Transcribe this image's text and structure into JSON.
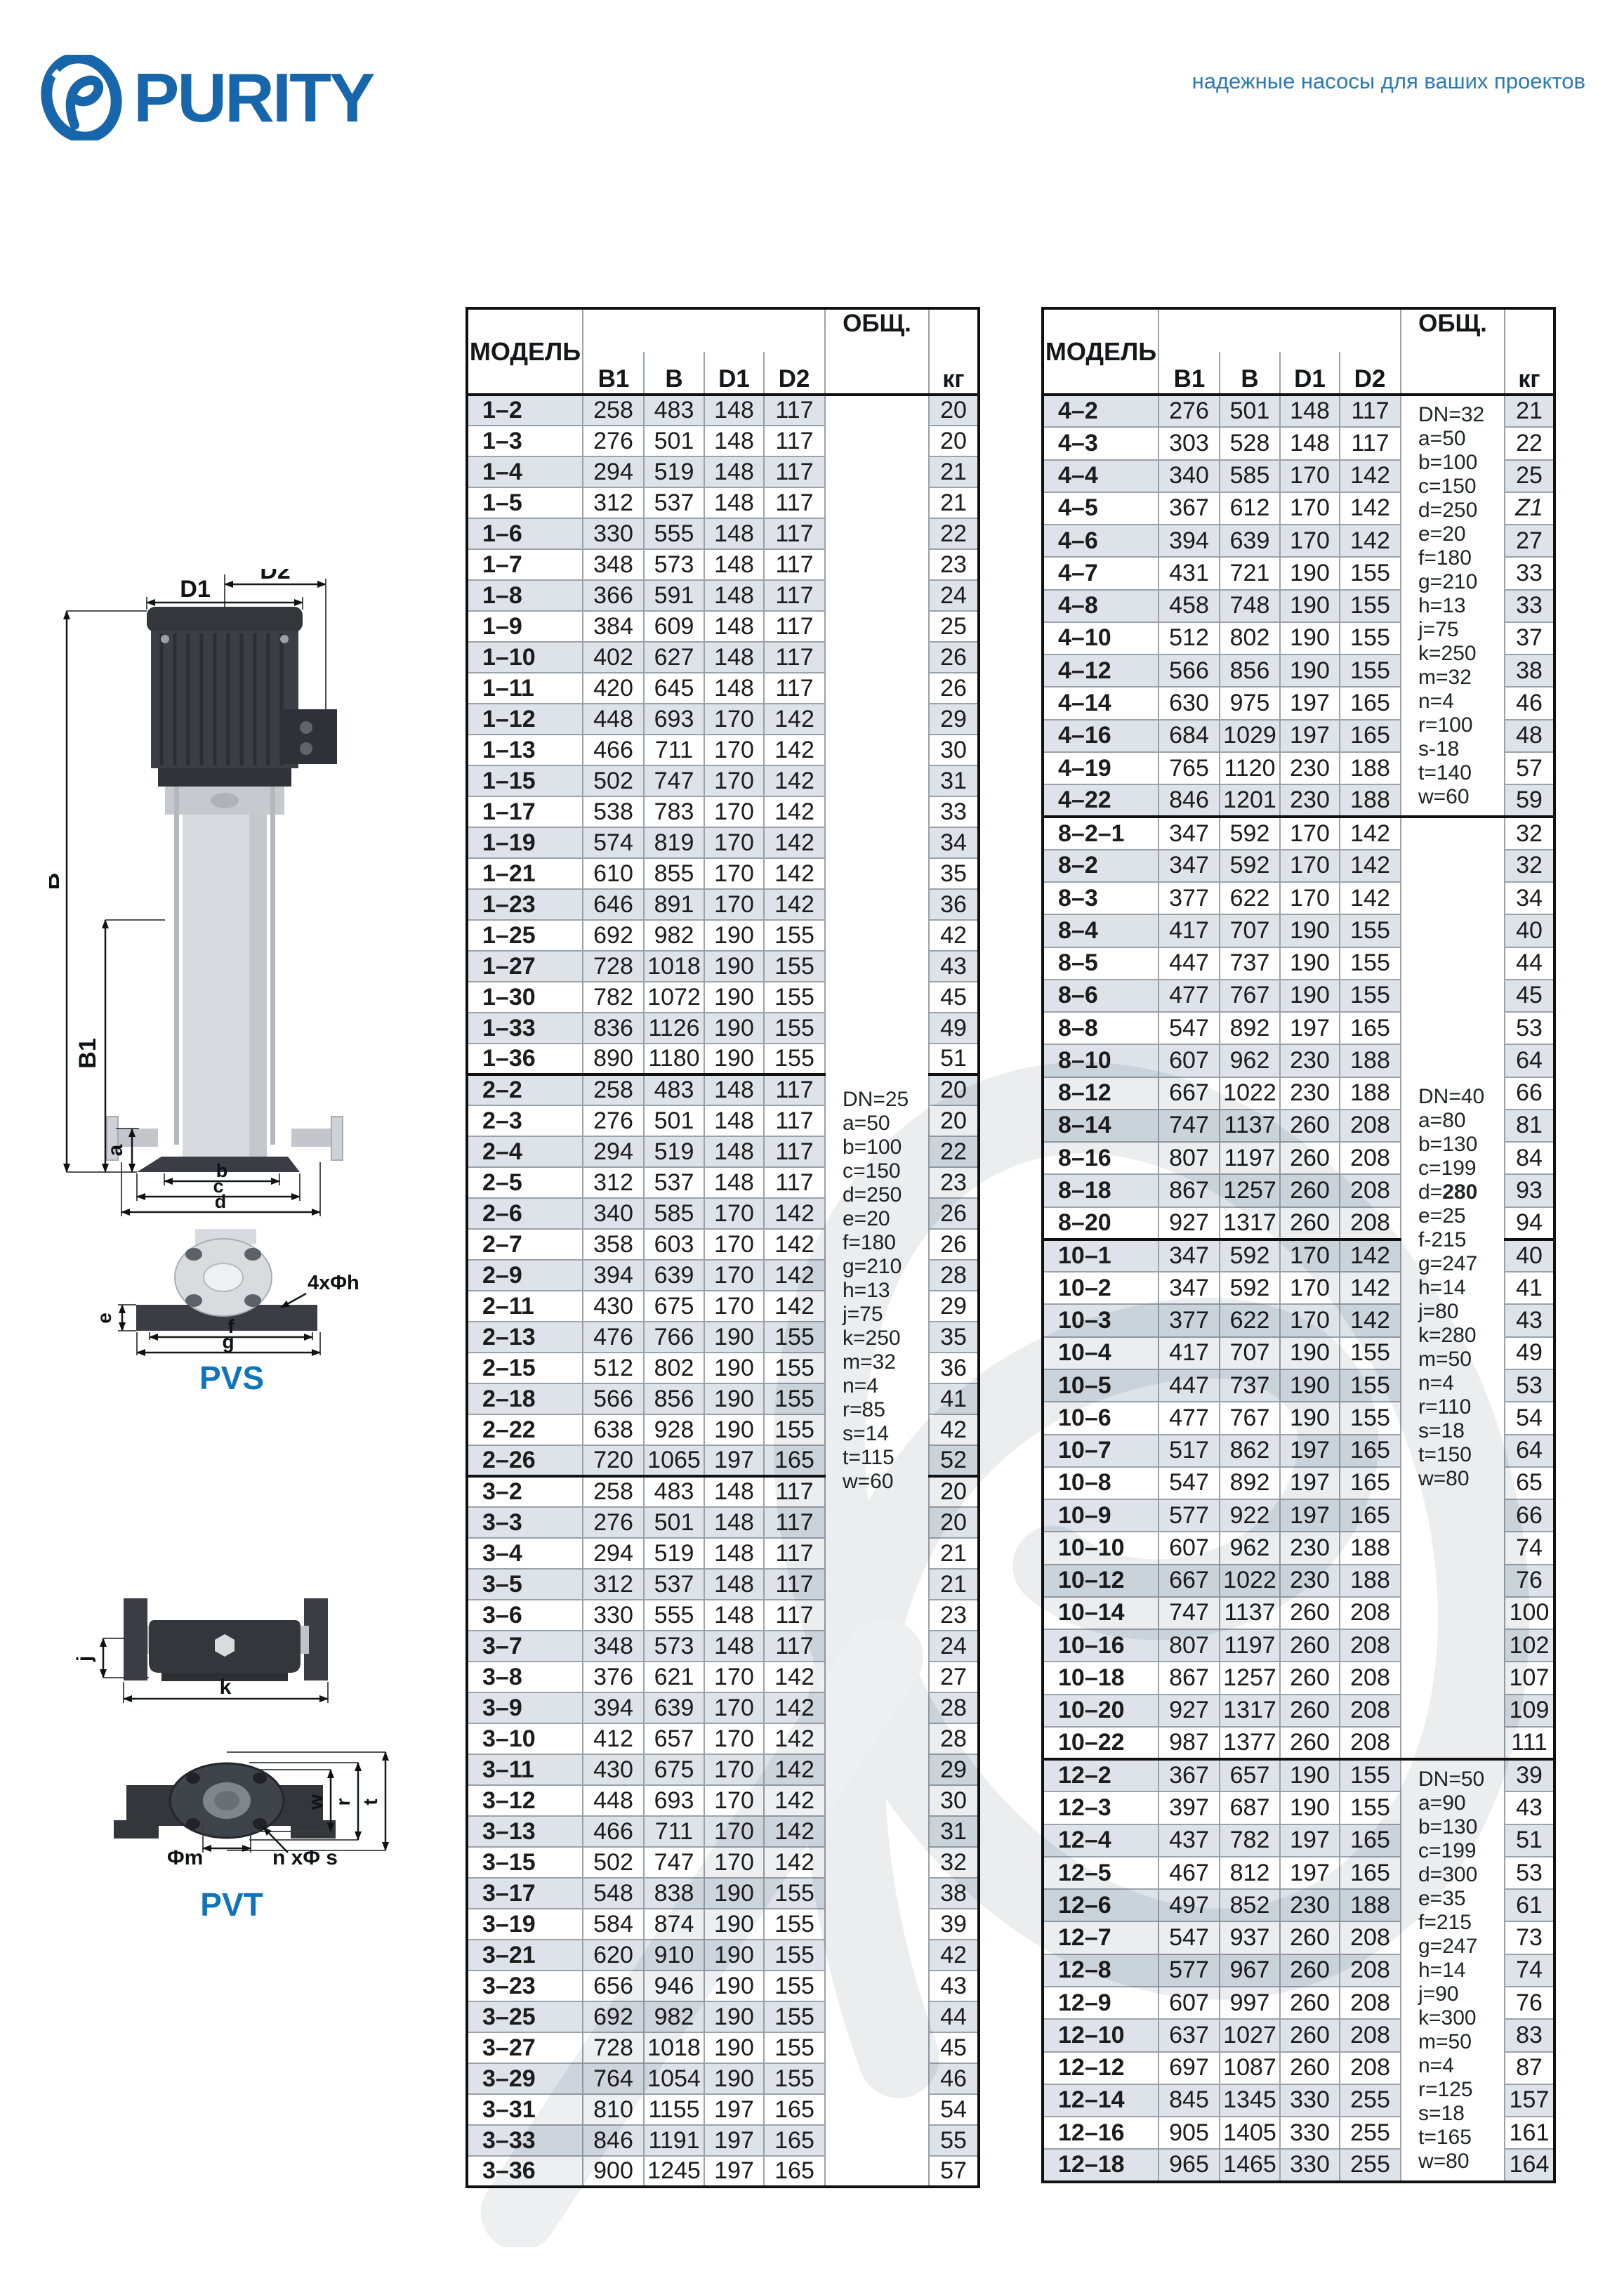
{
  "brand": {
    "name": "PURITY",
    "tagline": "надежные насосы для ваших проектов"
  },
  "columns": {
    "model": "МОДЕЛЬ",
    "b1": "B1",
    "b": "B",
    "d1": "D1",
    "d2": "D2",
    "obshch": "ОБЩ.",
    "kg": "кг"
  },
  "diagrams": {
    "pvs_label": "PVS",
    "pvt_label": "PVT",
    "dims": {
      "D1": "D1",
      "D2": "D2",
      "B": "B",
      "B1": "B1",
      "a": "a",
      "b": "b",
      "c": "c",
      "d": "d",
      "e": "e",
      "f": "f",
      "g": "g",
      "h4": "4xΦh",
      "j": "j",
      "k": "k",
      "w": "w",
      "r": "r",
      "t": "t",
      "m": "Φm",
      "ns": "n xΦ s"
    }
  },
  "tables": [
    {
      "name": "pvs-pvt-1-2-3",
      "note_groups": [
        {
          "sections": [
            0,
            1,
            2
          ],
          "lines": [
            "DN=25",
            "a=50",
            "b=100",
            "c=150",
            "d=250",
            "e=20",
            "f=180",
            "g=210",
            "h=13",
            "j=75",
            "k=250",
            "m=32",
            "n=4",
            "r=85",
            "s=14",
            "t=115",
            "w=60"
          ]
        }
      ],
      "sections": [
        {
          "rows": [
            [
              "1–2",
              258,
              483,
              148,
              117,
              "20"
            ],
            [
              "1–3",
              276,
              501,
              148,
              117,
              "20"
            ],
            [
              "1–4",
              294,
              519,
              148,
              117,
              "21"
            ],
            [
              "1–5",
              312,
              537,
              148,
              117,
              "21"
            ],
            [
              "1–6",
              330,
              555,
              148,
              117,
              "22"
            ],
            [
              "1–7",
              348,
              573,
              148,
              117,
              "23"
            ],
            [
              "1–8",
              366,
              591,
              148,
              117,
              "24"
            ],
            [
              "1–9",
              384,
              609,
              148,
              117,
              "25"
            ],
            [
              "1–10",
              402,
              627,
              148,
              117,
              "26"
            ],
            [
              "1–11",
              420,
              645,
              148,
              117,
              "26"
            ],
            [
              "1–12",
              448,
              693,
              170,
              142,
              "29"
            ],
            [
              "1–13",
              466,
              711,
              170,
              142,
              "30"
            ],
            [
              "1–15",
              502,
              747,
              170,
              142,
              "31"
            ],
            [
              "1–17",
              538,
              783,
              170,
              142,
              "33"
            ],
            [
              "1–19",
              574,
              819,
              170,
              142,
              "34"
            ],
            [
              "1–21",
              610,
              855,
              170,
              142,
              "35"
            ],
            [
              "1–23",
              646,
              891,
              170,
              142,
              "36"
            ],
            [
              "1–25",
              692,
              982,
              190,
              155,
              "42"
            ],
            [
              "1–27",
              728,
              1018,
              190,
              155,
              "43"
            ],
            [
              "1–30",
              782,
              1072,
              190,
              155,
              "45"
            ],
            [
              "1–33",
              836,
              1126,
              190,
              155,
              "49"
            ],
            [
              "1–36",
              890,
              1180,
              190,
              155,
              "51"
            ]
          ]
        },
        {
          "rows": [
            [
              "2–2",
              258,
              483,
              148,
              117,
              "20"
            ],
            [
              "2–3",
              276,
              501,
              148,
              117,
              "20"
            ],
            [
              "2–4",
              294,
              519,
              148,
              117,
              "22"
            ],
            [
              "2–5",
              312,
              537,
              148,
              117,
              "23"
            ],
            [
              "2–6",
              340,
              585,
              170,
              142,
              "26"
            ],
            [
              "2–7",
              358,
              603,
              170,
              142,
              "26"
            ],
            [
              "2–9",
              394,
              639,
              170,
              142,
              "28"
            ],
            [
              "2–11",
              430,
              675,
              170,
              142,
              "29"
            ],
            [
              "2–13",
              476,
              766,
              190,
              155,
              "35"
            ],
            [
              "2–15",
              512,
              802,
              190,
              155,
              "36"
            ],
            [
              "2–18",
              566,
              856,
              190,
              155,
              "41"
            ],
            [
              "2–22",
              638,
              928,
              190,
              155,
              "42"
            ],
            [
              "2–26",
              720,
              1065,
              197,
              165,
              "52"
            ]
          ]
        },
        {
          "rows": [
            [
              "3–2",
              258,
              483,
              148,
              117,
              "20"
            ],
            [
              "3–3",
              276,
              501,
              148,
              117,
              "20"
            ],
            [
              "3–4",
              294,
              519,
              148,
              117,
              "21"
            ],
            [
              "3–5",
              312,
              537,
              148,
              117,
              "21"
            ],
            [
              "3–6",
              330,
              555,
              148,
              117,
              "23"
            ],
            [
              "3–7",
              348,
              573,
              148,
              117,
              "24"
            ],
            [
              "3–8",
              376,
              621,
              170,
              142,
              "27"
            ],
            [
              "3–9",
              394,
              639,
              170,
              142,
              "28"
            ],
            [
              "3–10",
              412,
              657,
              170,
              142,
              "28"
            ],
            [
              "3–11",
              430,
              675,
              170,
              142,
              "29"
            ],
            [
              "3–12",
              448,
              693,
              170,
              142,
              "30"
            ],
            [
              "3–13",
              466,
              711,
              170,
              142,
              "31"
            ],
            [
              "3–15",
              502,
              747,
              170,
              142,
              "32"
            ],
            [
              "3–17",
              548,
              838,
              190,
              155,
              "38"
            ],
            [
              "3–19",
              584,
              874,
              190,
              155,
              "39"
            ],
            [
              "3–21",
              620,
              910,
              190,
              155,
              "42"
            ],
            [
              "3–23",
              656,
              946,
              190,
              155,
              "43"
            ],
            [
              "3–25",
              692,
              982,
              190,
              155,
              "44"
            ],
            [
              "3–27",
              728,
              1018,
              190,
              155,
              "45"
            ],
            [
              "3–29",
              764,
              1054,
              190,
              155,
              "46"
            ],
            [
              "3–31",
              810,
              1155,
              197,
              165,
              "54"
            ],
            [
              "3–33",
              846,
              1191,
              197,
              165,
              "55"
            ],
            [
              "3–36",
              900,
              1245,
              197,
              165,
              "57"
            ]
          ]
        }
      ]
    },
    {
      "name": "pvs-pvt-4-8-10-12",
      "note_groups": [
        {
          "sections": [
            0
          ],
          "lines": [
            "DN=32",
            "a=50",
            "b=100",
            "c=150",
            "d=250",
            "e=20",
            "f=180",
            "g=210",
            "h=13",
            "j=75",
            "k=250",
            "m=32",
            "n=4",
            "r=100",
            "s-18",
            "t=140",
            "w=60"
          ]
        },
        {
          "sections": [
            1,
            2
          ],
          "lines": [
            "DN=40",
            "a=80",
            "b=130",
            "c=199",
            "d=**280**",
            "e=25",
            "f-215",
            "g=247",
            "h=14",
            "j=80",
            "k=280",
            "m=50",
            "n=4",
            "r=110",
            "s=18",
            "t=150",
            "w=80"
          ]
        },
        {
          "sections": [
            3
          ],
          "lines": [
            "DN=50",
            "a=90",
            "b=130",
            "c=199",
            "d=300",
            "e=35",
            "f=215",
            "g=247",
            "h=14",
            "j=90",
            "k=300",
            "m=50",
            "n=4",
            "r=125",
            "s=18",
            "t=165",
            "w=80"
          ]
        }
      ],
      "sections": [
        {
          "rows": [
            [
              "4–2",
              276,
              501,
              148,
              117,
              "21"
            ],
            [
              "4–3",
              303,
              528,
              148,
              117,
              "22"
            ],
            [
              "4–4",
              340,
              585,
              170,
              142,
              "25"
            ],
            [
              "4–5",
              367,
              612,
              170,
              142,
              "Z1"
            ],
            [
              "4–6",
              394,
              639,
              170,
              142,
              "27"
            ],
            [
              "4–7",
              431,
              721,
              190,
              155,
              "33"
            ],
            [
              "4–8",
              458,
              748,
              190,
              155,
              "33"
            ],
            [
              "4–10",
              512,
              802,
              190,
              155,
              "37"
            ],
            [
              "4–12",
              566,
              856,
              190,
              155,
              "38"
            ],
            [
              "4–14",
              630,
              975,
              197,
              165,
              "46"
            ],
            [
              "4–16",
              684,
              1029,
              197,
              165,
              "48"
            ],
            [
              "4–19",
              765,
              1120,
              230,
              188,
              "57"
            ],
            [
              "4–22",
              846,
              1201,
              230,
              188,
              "59"
            ]
          ]
        },
        {
          "rows": [
            [
              "8–2–1",
              347,
              592,
              170,
              142,
              "32"
            ],
            [
              "8–2",
              347,
              592,
              170,
              142,
              "32"
            ],
            [
              "8–3",
              377,
              622,
              170,
              142,
              "34"
            ],
            [
              "8–4",
              417,
              707,
              190,
              155,
              "40"
            ],
            [
              "8–5",
              447,
              737,
              190,
              155,
              "44"
            ],
            [
              "8–6",
              477,
              767,
              190,
              155,
              "45"
            ],
            [
              "8–8",
              547,
              892,
              197,
              165,
              "53"
            ],
            [
              "8–10",
              607,
              962,
              230,
              188,
              "64"
            ],
            [
              "8–12",
              667,
              1022,
              230,
              188,
              "66"
            ],
            [
              "8–14",
              747,
              1137,
              260,
              208,
              "81"
            ],
            [
              "8–16",
              807,
              1197,
              260,
              208,
              "84"
            ],
            [
              "8–18",
              867,
              1257,
              260,
              208,
              "93"
            ],
            [
              "8–20",
              927,
              1317,
              260,
              208,
              "94"
            ]
          ]
        },
        {
          "rows": [
            [
              "10–1",
              347,
              592,
              170,
              142,
              "40"
            ],
            [
              "10–2",
              347,
              592,
              170,
              142,
              "41"
            ],
            [
              "10–3",
              377,
              622,
              170,
              142,
              "43"
            ],
            [
              "10–4",
              417,
              707,
              190,
              155,
              "49"
            ],
            [
              "10–5",
              447,
              737,
              190,
              155,
              "53"
            ],
            [
              "10–6",
              477,
              767,
              190,
              155,
              "54"
            ],
            [
              "10–7",
              517,
              862,
              197,
              165,
              "64"
            ],
            [
              "10–8",
              547,
              892,
              197,
              165,
              "65"
            ],
            [
              "10–9",
              577,
              922,
              197,
              165,
              "66"
            ],
            [
              "10–10",
              607,
              962,
              230,
              188,
              "74"
            ],
            [
              "10–12",
              667,
              1022,
              230,
              188,
              "76"
            ],
            [
              "10–14",
              747,
              1137,
              260,
              208,
              "100"
            ],
            [
              "10–16",
              807,
              1197,
              260,
              208,
              "102"
            ],
            [
              "10–18",
              867,
              1257,
              260,
              208,
              "107"
            ],
            [
              "10–20",
              927,
              1317,
              260,
              208,
              "109"
            ],
            [
              "10–22",
              987,
              1377,
              260,
              208,
              "111"
            ]
          ]
        },
        {
          "rows": [
            [
              "12–2",
              367,
              657,
              190,
              155,
              "39"
            ],
            [
              "12–3",
              397,
              687,
              190,
              155,
              "43"
            ],
            [
              "12–4",
              437,
              782,
              197,
              165,
              "51"
            ],
            [
              "12–5",
              467,
              812,
              197,
              165,
              "53"
            ],
            [
              "12–6",
              497,
              852,
              230,
              188,
              "61"
            ],
            [
              "12–7",
              547,
              937,
              260,
              208,
              "73"
            ],
            [
              "12–8",
              577,
              967,
              260,
              208,
              "74"
            ],
            [
              "12–9",
              607,
              997,
              260,
              208,
              "76"
            ],
            [
              "12–10",
              637,
              1027,
              260,
              208,
              "83"
            ],
            [
              "12–12",
              697,
              1087,
              260,
              208,
              "87"
            ],
            [
              "12–14",
              845,
              1345,
              330,
              255,
              "157"
            ],
            [
              "12–16",
              905,
              1405,
              330,
              255,
              "161"
            ],
            [
              "12–18",
              965,
              1465,
              330,
              255,
              "164"
            ]
          ]
        }
      ]
    }
  ]
}
